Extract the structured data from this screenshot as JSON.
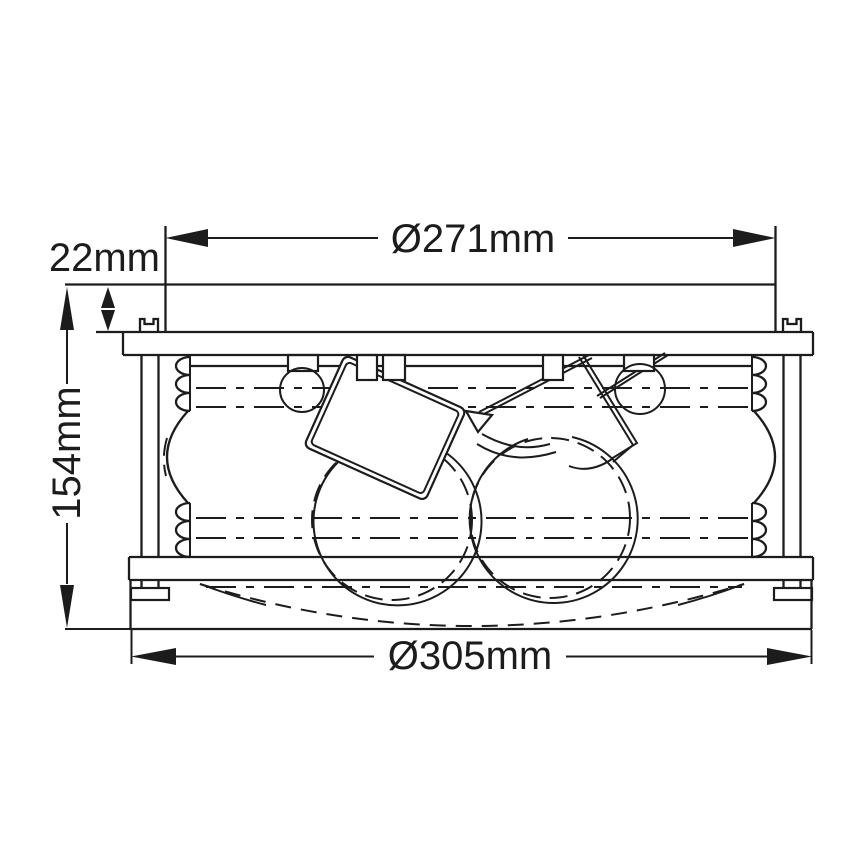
{
  "page": {
    "background": "#ffffff",
    "line_color": "#1c1c1c"
  },
  "drawing": {
    "type": "technical-dimension-drawing",
    "subject": "flush ceiling light side elevation",
    "dimensions": {
      "top_diameter": {
        "label": "Ø271mm"
      },
      "canopy_height": {
        "label": "22mm"
      },
      "overall_height": {
        "label": "154mm"
      },
      "bottom_diameter": {
        "label": "Ø305mm"
      }
    }
  }
}
